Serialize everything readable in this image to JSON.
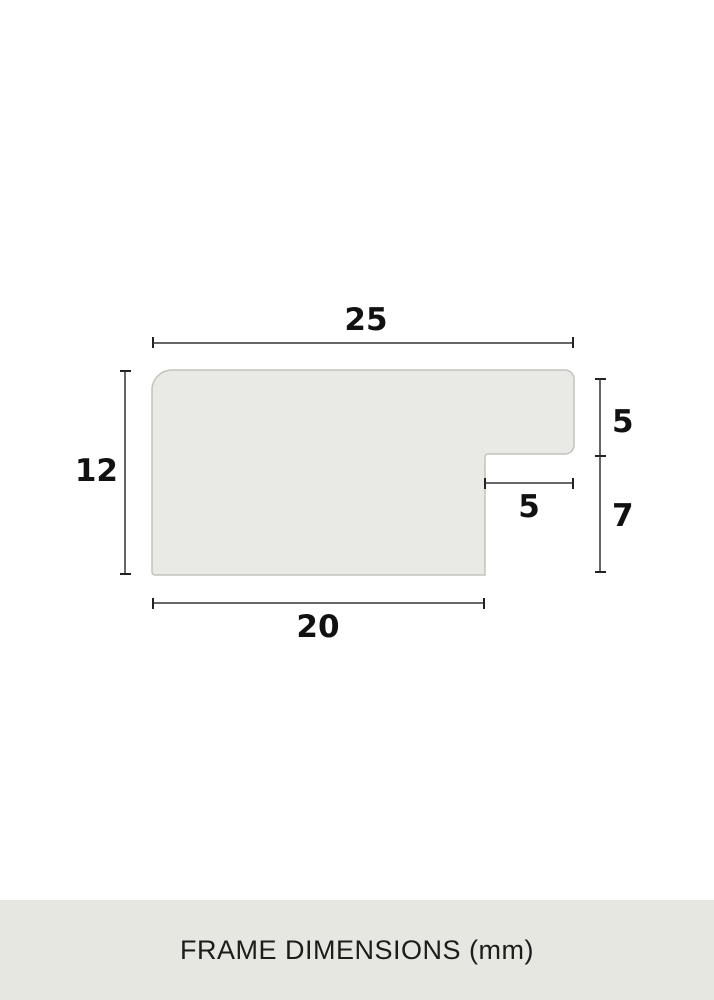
{
  "footer": {
    "caption": "FRAME DIMENSIONS (mm)"
  },
  "diagram": {
    "unit": "mm",
    "dimensions": {
      "top_width": {
        "label": "25",
        "value": 25
      },
      "left_height": {
        "label": "12",
        "value": 12
      },
      "right_upper_height": {
        "label": "5",
        "value": 5
      },
      "right_lower_height": {
        "label": "7",
        "value": 7
      },
      "rabbet_width": {
        "label": "5",
        "value": 5
      },
      "bottom_width": {
        "label": "20",
        "value": 20
      }
    }
  },
  "colors": {
    "background": "#ffffff",
    "shape_fill": "#e9e9e5",
    "shape_stroke": "#c3c3bc",
    "dimension_line": "#333333",
    "label_text": "#111111",
    "footer_background": "#e7e7e2",
    "footer_text": "#1c1c1c"
  }
}
